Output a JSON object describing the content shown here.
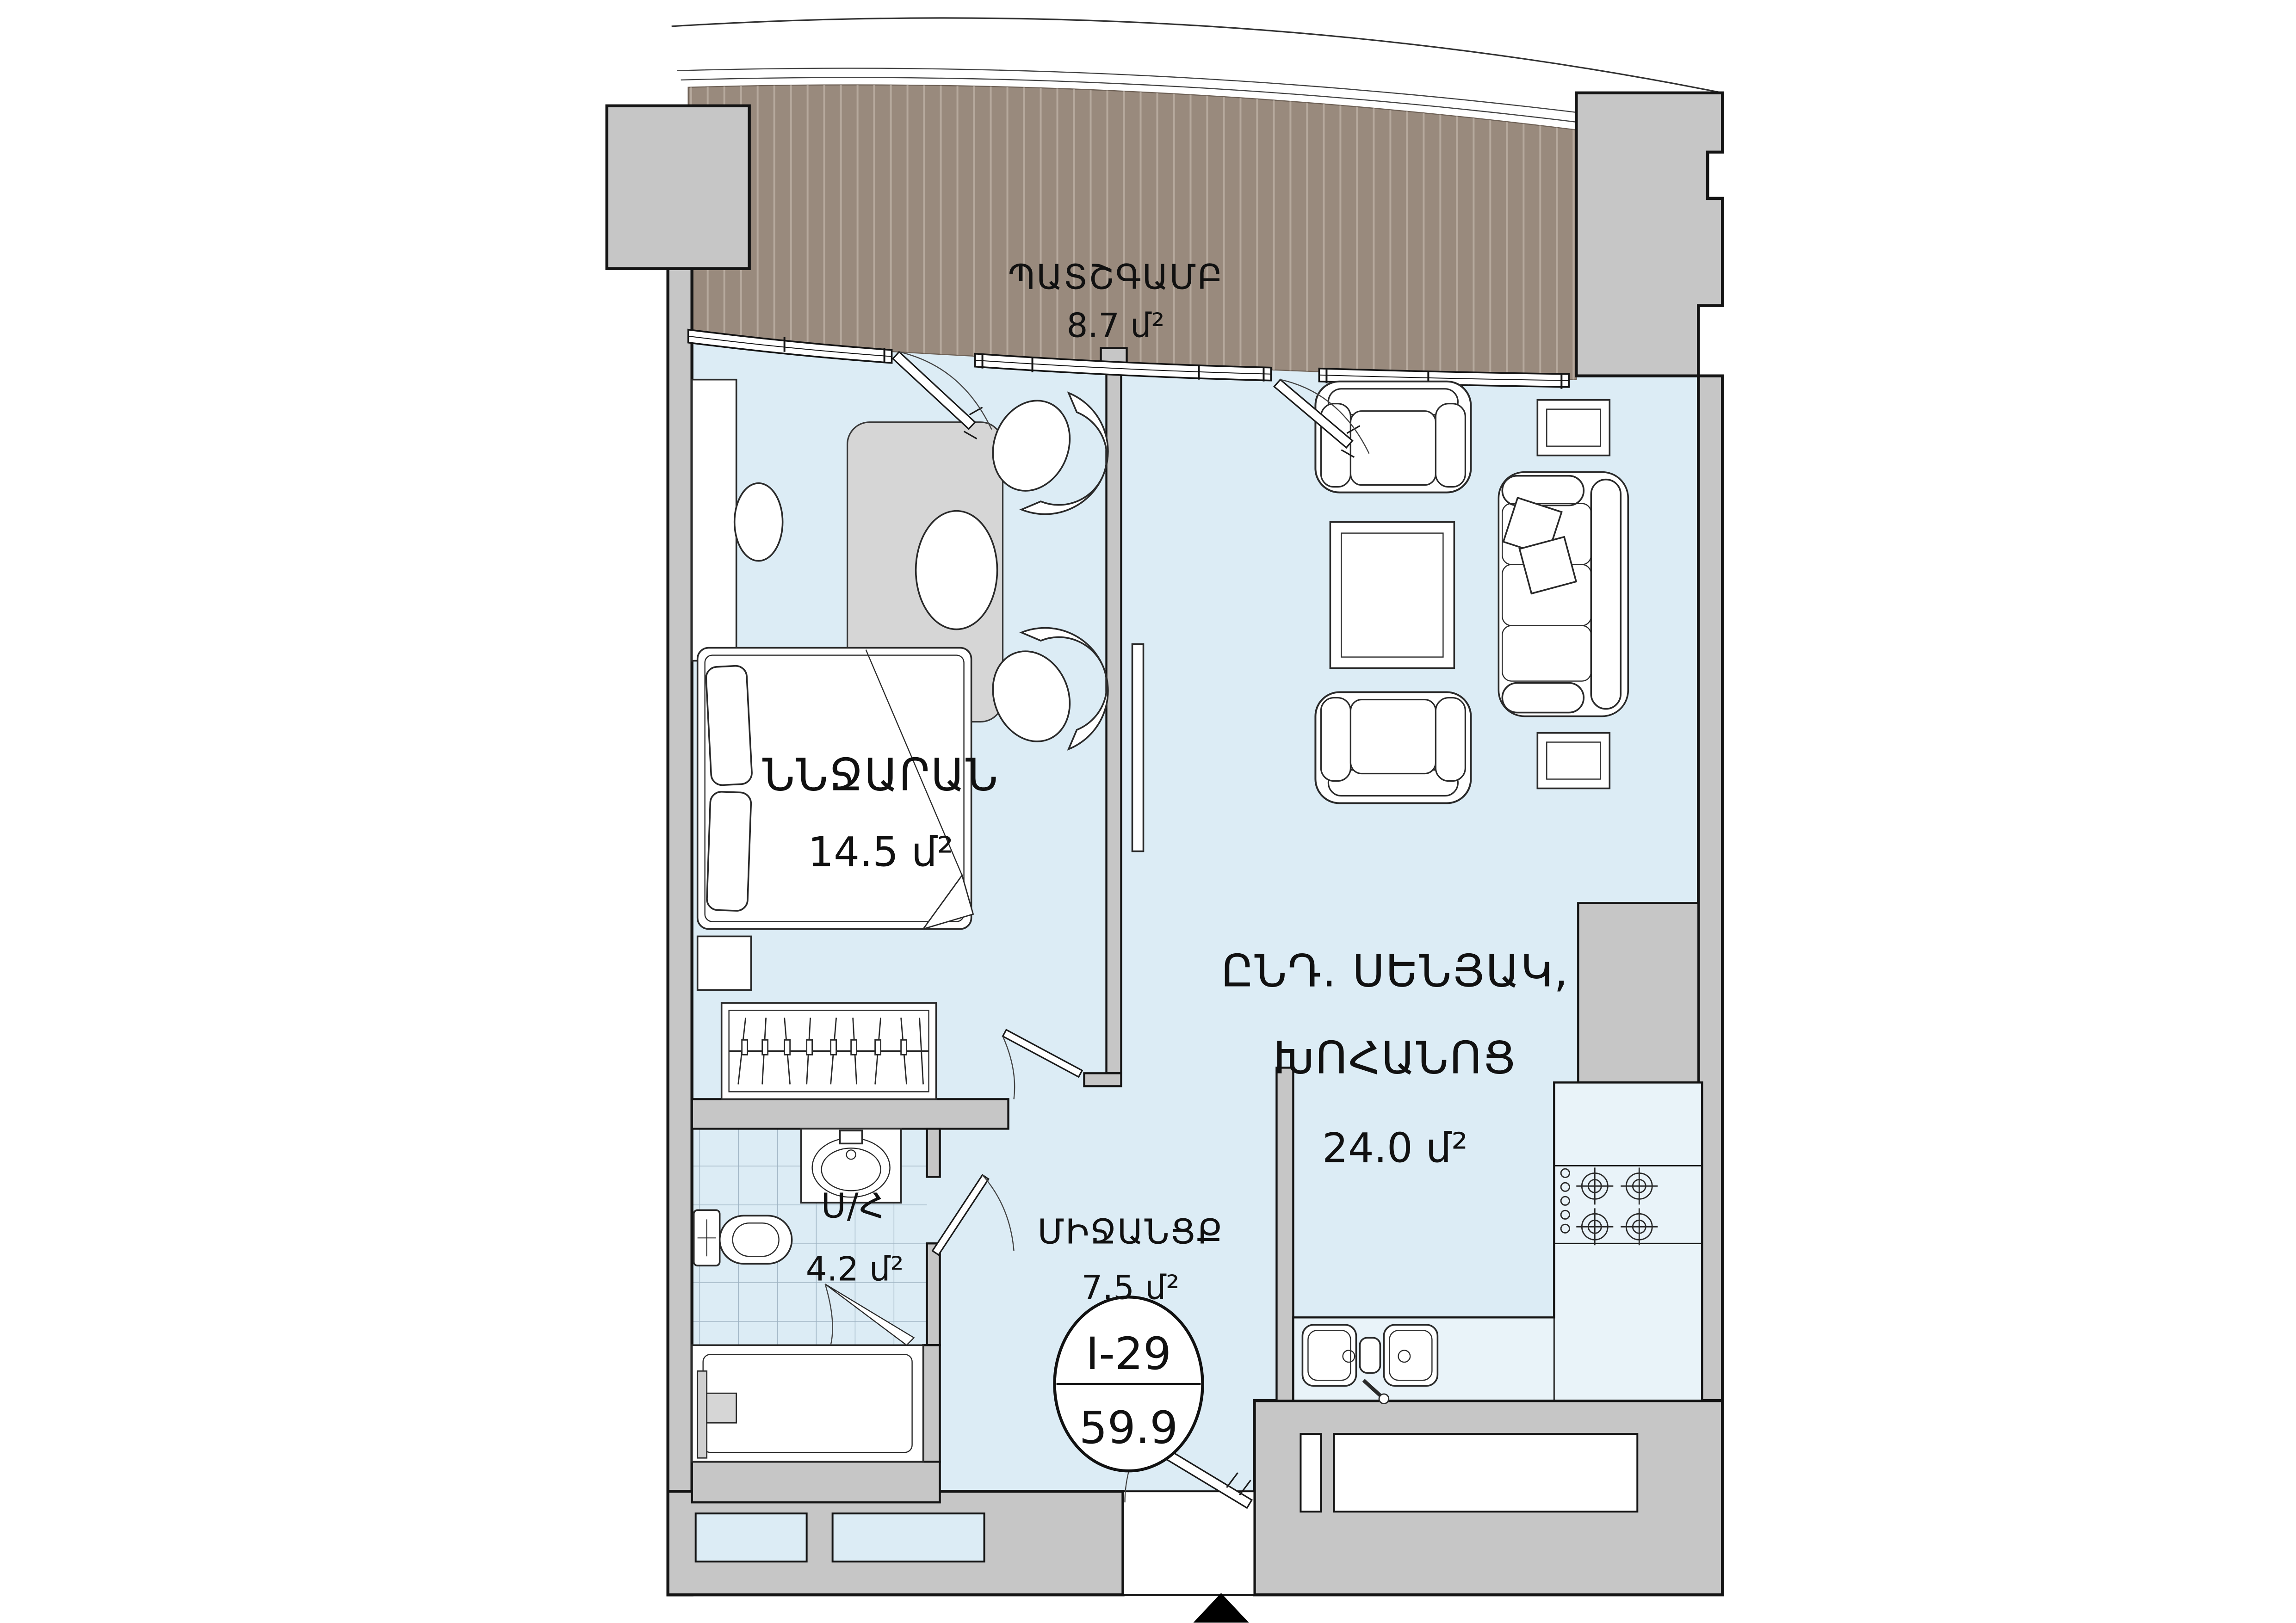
{
  "plan": {
    "title": "apartment floor plan",
    "unit_label": "մ²",
    "rooms": [
      {
        "id": "balcony",
        "name": "ՊԱՏՇԳԱՄԲ",
        "area": "8.7 մ²"
      },
      {
        "id": "bedroom",
        "name": "ՆՆՋԱՐԱՆ",
        "area": "14.5 մ²"
      },
      {
        "id": "living_kitchen",
        "name_line1": "ԸՆԴ. ՍԵՆՅԱԿ,",
        "name_line2": "ԽՈՀԱՆՈՑ",
        "area": "24.0 մ²"
      },
      {
        "id": "bathroom",
        "name": "Ս/Հ",
        "area": "4.2 մ²"
      },
      {
        "id": "hallway",
        "name": "ՄԻՋԱՆՑՔ",
        "area": "7.5 մ²"
      }
    ],
    "badge": {
      "unit_number": "I-29",
      "total_area": "59.9"
    },
    "colors": {
      "floor": "#dcecf5",
      "wall": "#c6c6c6",
      "balcony_deck": "#998a7d",
      "plank_line": "#cdc2b8",
      "rug": "#d6d6d6",
      "tile_line": "#93a9b9",
      "outline": "#141414",
      "marker": "#000000"
    }
  }
}
